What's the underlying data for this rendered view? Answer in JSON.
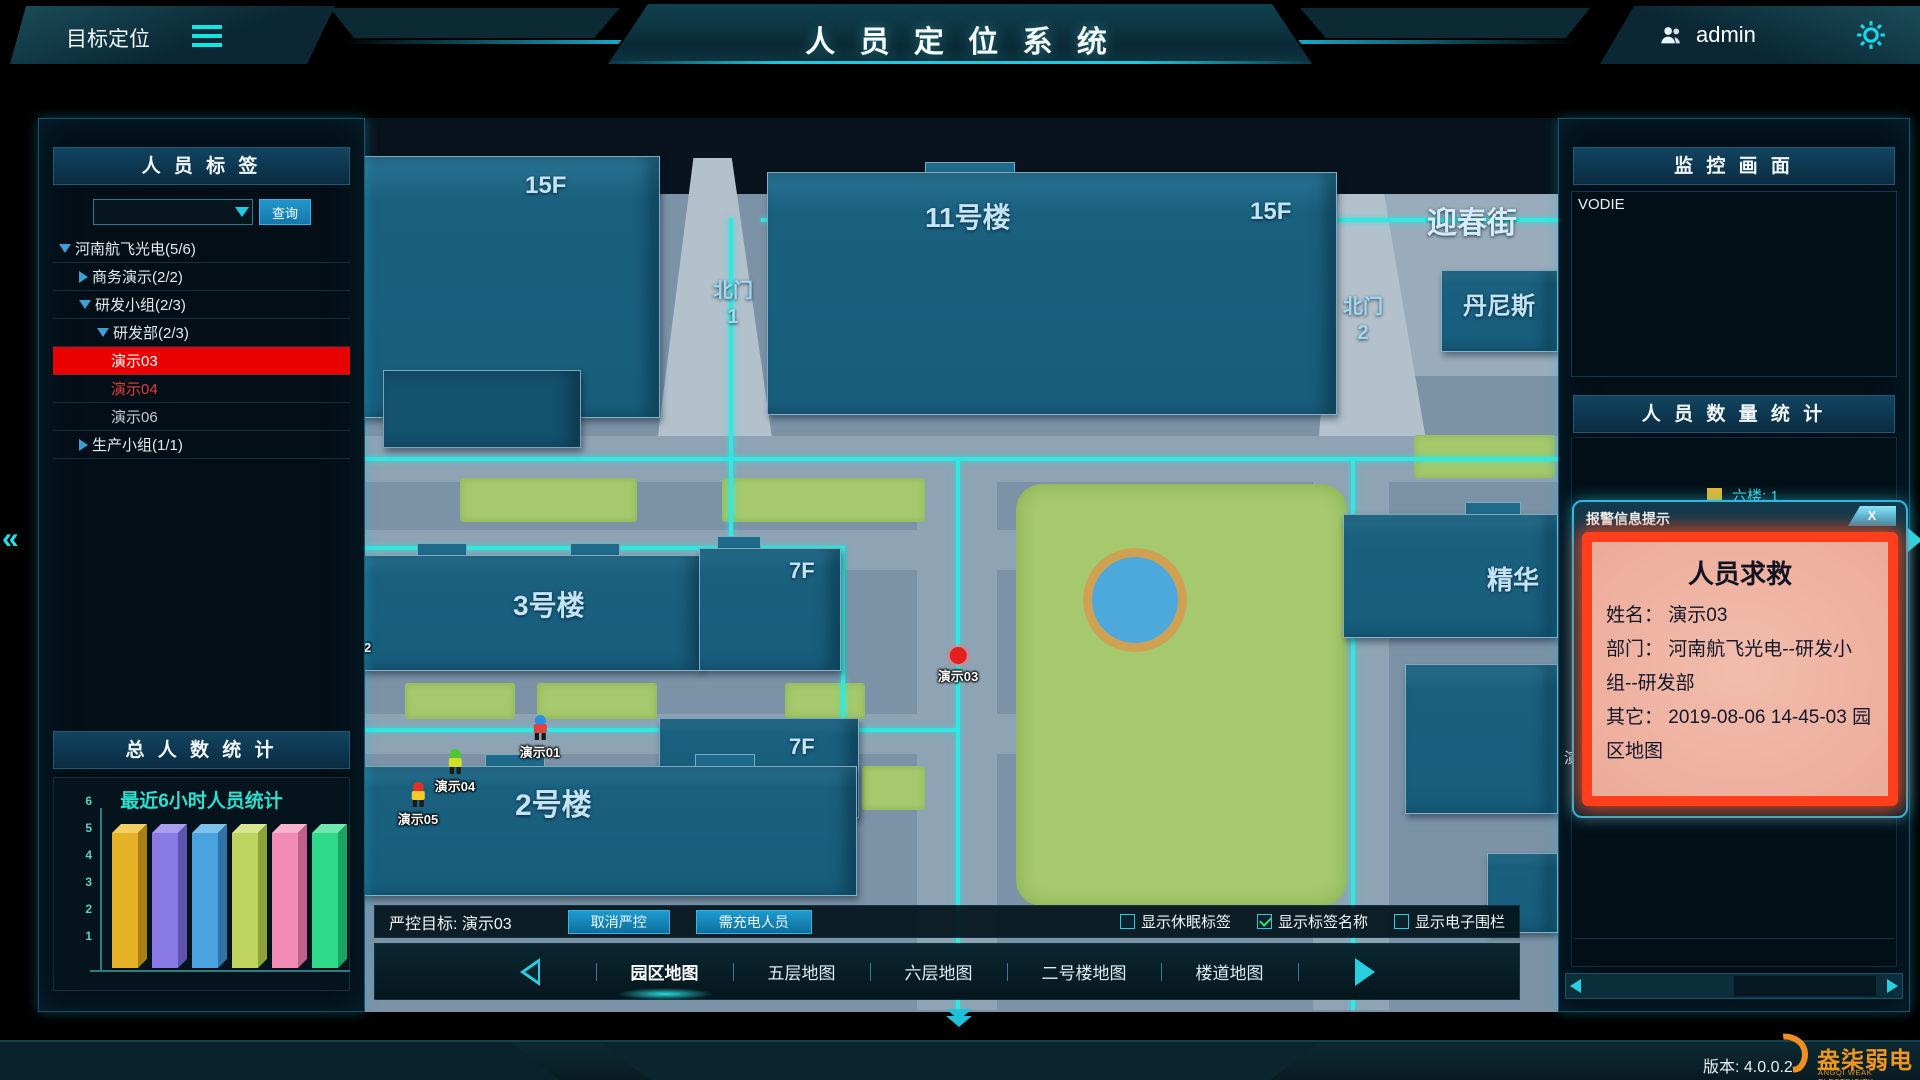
{
  "header": {
    "menu_label": "目标定位",
    "title": "人 员 定 位 系 统",
    "user_name": "admin"
  },
  "icons": {
    "menu_icon": "three-bars",
    "user_icon": "two-person-silhouette",
    "gear_icon": "gear",
    "search_dropdown_icon": "▼",
    "collapse_left_icon": "«",
    "expand_right_icon": "▶",
    "nav_prev_icon": "◀",
    "nav_next_icon": "▶",
    "close_icon": "X",
    "scroll_prev_icon": "◀",
    "scroll_next_icon": "▶",
    "collapse_down_icon": "⌄⌄"
  },
  "left_panel": {
    "header": "人 员 标 签",
    "search_value": "",
    "search_button": "查询",
    "tree": [
      {
        "label": "河南航飞光电(5/6)",
        "indent": 0,
        "arrow": "down",
        "state": "normal"
      },
      {
        "label": "商务演示(2/2)",
        "indent": 1,
        "arrow": "right",
        "state": "normal"
      },
      {
        "label": "研发小组(2/3)",
        "indent": 1,
        "arrow": "down",
        "state": "normal"
      },
      {
        "label": "研发部(2/3)",
        "indent": 2,
        "arrow": "down",
        "state": "normal"
      },
      {
        "label": "演示03",
        "indent": 3,
        "arrow": "",
        "state": "selected-alarm"
      },
      {
        "label": "演示04",
        "indent": 3,
        "arrow": "",
        "state": "alarm-text"
      },
      {
        "label": "演示06",
        "indent": 3,
        "arrow": "",
        "state": "offline"
      },
      {
        "label": "生产小组(1/1)",
        "indent": 1,
        "arrow": "right",
        "state": "normal"
      }
    ],
    "total_header": "总 人 数 统 计"
  },
  "chart_data": {
    "type": "bar",
    "title": "最近6小时人员统计",
    "categories": [
      "",
      "",
      "",
      "",
      "",
      ""
    ],
    "values": [
      5,
      5,
      5,
      5,
      5,
      5
    ],
    "ylim": [
      0,
      6
    ],
    "yticks": [
      1,
      2,
      3,
      4,
      5,
      6
    ],
    "colors": [
      "#e5b227",
      "#8a7ae6",
      "#4aa2de",
      "#bfd35f",
      "#f28cb4",
      "#2fd98a"
    ],
    "colors_top": [
      "#f2cf5e",
      "#a99ef0",
      "#7cc2ec",
      "#d9e68f",
      "#f7b2cc",
      "#6ee8b0"
    ],
    "colors_side": [
      "#a87f16",
      "#5f54b0",
      "#2f74a8",
      "#8ea23c",
      "#c05f88",
      "#1ba362"
    ],
    "grid": false,
    "legend": false
  },
  "map": {
    "labels": {
      "tower_a_floors": "15F",
      "bldg11_name": "11号楼",
      "bldg11_floors": "15F",
      "street": "迎春街",
      "dennis": "丹尼斯",
      "gate1_line1": "北门",
      "gate1_line2": "1",
      "gate2_line1": "北门",
      "gate2_line2": "2",
      "bldg3_name": "3号楼",
      "bldg7a_floors": "7F",
      "bldg2_name": "2号楼",
      "bldg7b_floors": "7F",
      "jinghua": "精华"
    },
    "markers": [
      {
        "name": "演示03",
        "type": "dot",
        "x": 593,
        "y": 539,
        "color": "#e31f1f"
      },
      {
        "name": "演示01",
        "type": "sprite",
        "x": 175,
        "y": 607,
        "cap": "#2a8fe0",
        "body": "#e04040"
      },
      {
        "name": "演示04",
        "type": "sprite",
        "x": 90,
        "y": 641,
        "cap": "#52c632",
        "body": "#cede2a"
      },
      {
        "name": "演示05",
        "type": "sprite",
        "x": 53,
        "y": 674,
        "cap": "#e33022",
        "body": "#f2cb2a"
      },
      {
        "name": "演示02",
        "type": "clipped-label",
        "x": -14,
        "y": 527
      }
    ]
  },
  "control_bar": {
    "target_label": "严控目标: 演示03",
    "cancel_button": "取消严控",
    "charge_button": "需充电人员",
    "checkboxes": [
      {
        "label": "显示休眠标签",
        "checked": false
      },
      {
        "label": "显示标签名称",
        "checked": true
      },
      {
        "label": "显示电子围栏",
        "checked": false
      }
    ]
  },
  "map_nav": {
    "items": [
      "园区地图",
      "五层地图",
      "六层地图",
      "二号楼地图",
      "楼道地图"
    ],
    "active": "园区地图"
  },
  "right_panel": {
    "monitor_header": "监 控 画 面",
    "video_label": "VODIE",
    "stats_header": "人 员 数 量 统 计",
    "legend": [
      {
        "label": "六楼: 1",
        "color": "#e8b428"
      }
    ],
    "occluded_text": "演"
  },
  "alarm_popup": {
    "title": "报警信息提示",
    "close_label": "X",
    "alert_title": "人员求救",
    "fields": [
      {
        "label": "姓名：",
        "value": "演示03"
      },
      {
        "label": "部门：",
        "value": "河南航飞光电--研发小组--研发部"
      },
      {
        "label": "其它：",
        "value": "2019-08-06 14-45-03 园区地图"
      }
    ]
  },
  "footer": {
    "version": "版本: 4.0.0.2",
    "logo_text": "盎柒弱电",
    "logo_subtext": "ANGQI WEAK ELECTRICITY"
  }
}
